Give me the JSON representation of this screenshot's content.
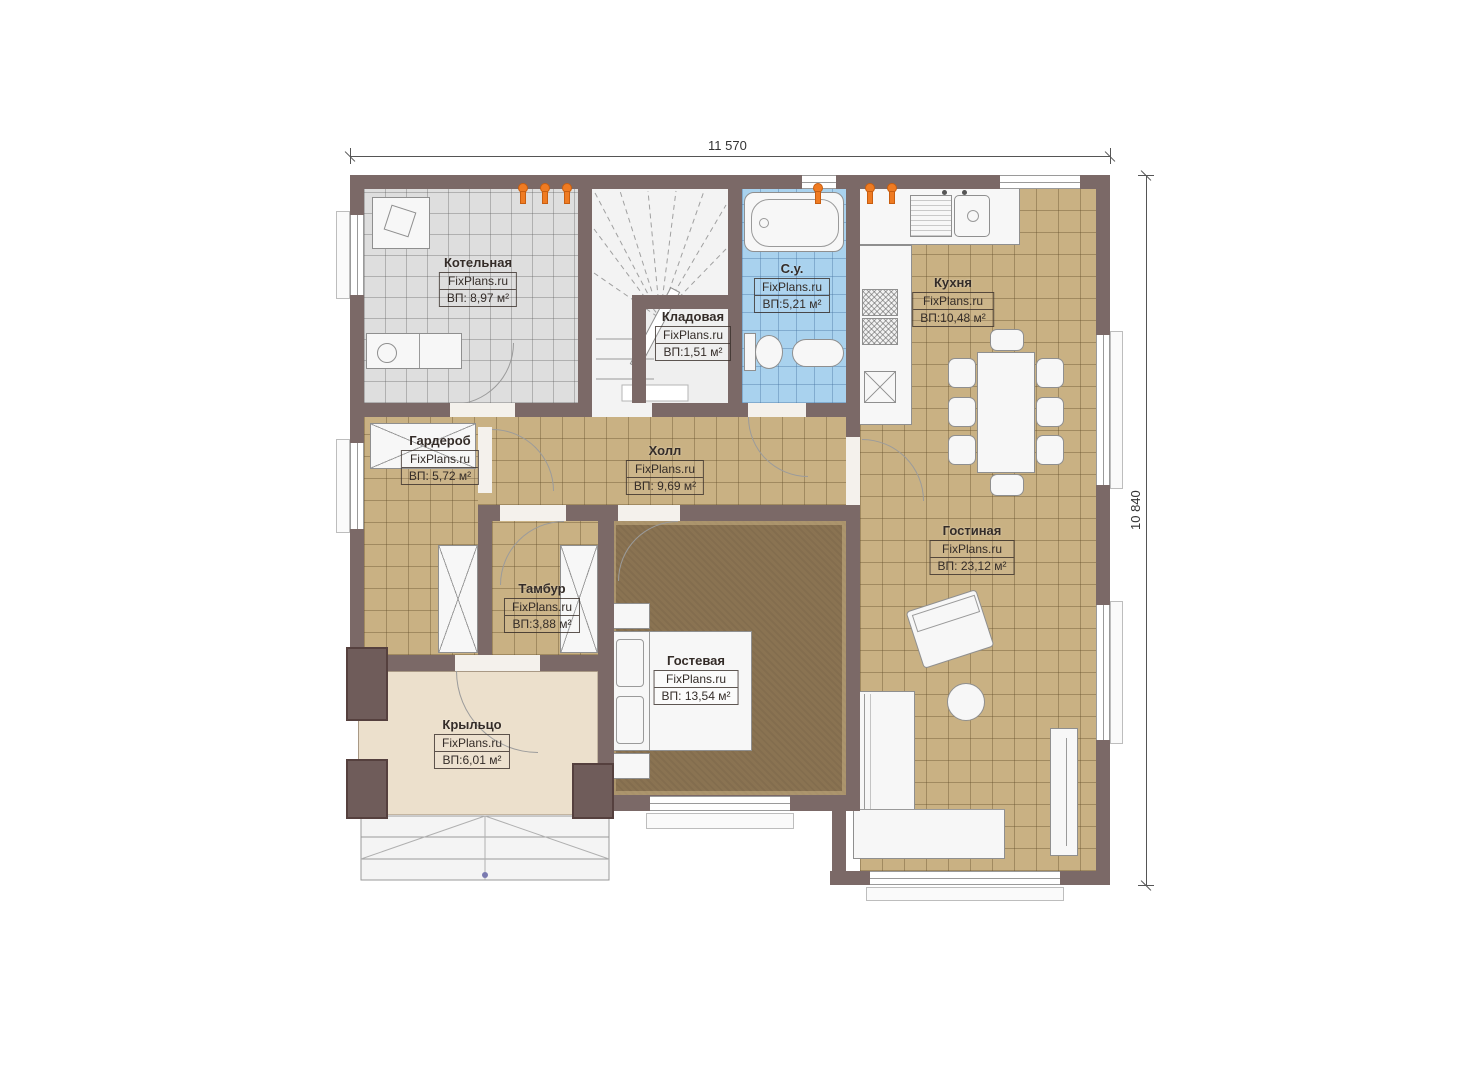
{
  "plan_title": "Floor plan (first floor)",
  "brand": "FixPlans.ru",
  "dimensions": {
    "top": "11 570",
    "right": "10 840"
  },
  "colors": {
    "wall": "#7b6967",
    "tile_tan": "#c9b183",
    "tile_gray": "#dedede",
    "tile_blue": "#a9d2ee",
    "carpet": "#8a7352",
    "porch": "#ece0cc",
    "heating_marker": "#ef7b22"
  },
  "rooms": [
    {
      "name": "Котельная",
      "brand": "FixPlans.ru",
      "area": "ВП: 8,97 м²"
    },
    {
      "name": "Кладовая",
      "brand": "FixPlans.ru",
      "area": "ВП:1,51 м²"
    },
    {
      "name": "С.у.",
      "brand": "FixPlans.ru",
      "area": "ВП:5,21 м²"
    },
    {
      "name": "Кухня",
      "brand": "FixPlans.ru",
      "area": "ВП:10,48 м²"
    },
    {
      "name": "Гардероб",
      "brand": "FixPlans.ru",
      "area": "ВП: 5,72 м²"
    },
    {
      "name": "Холл",
      "brand": "FixPlans.ru",
      "area": "ВП: 9,69 м²"
    },
    {
      "name": "Гостиная",
      "brand": "FixPlans.ru",
      "area": "ВП: 23,12 м²"
    },
    {
      "name": "Тамбур",
      "brand": "FixPlans.ru",
      "area": "ВП:3,88 м²"
    },
    {
      "name": "Гостевая",
      "brand": "FixPlans.ru",
      "area": "ВП: 13,54 м²"
    },
    {
      "name": "Крыльцо",
      "brand": "FixPlans.ru",
      "area": "ВП:6,01 м²"
    }
  ]
}
